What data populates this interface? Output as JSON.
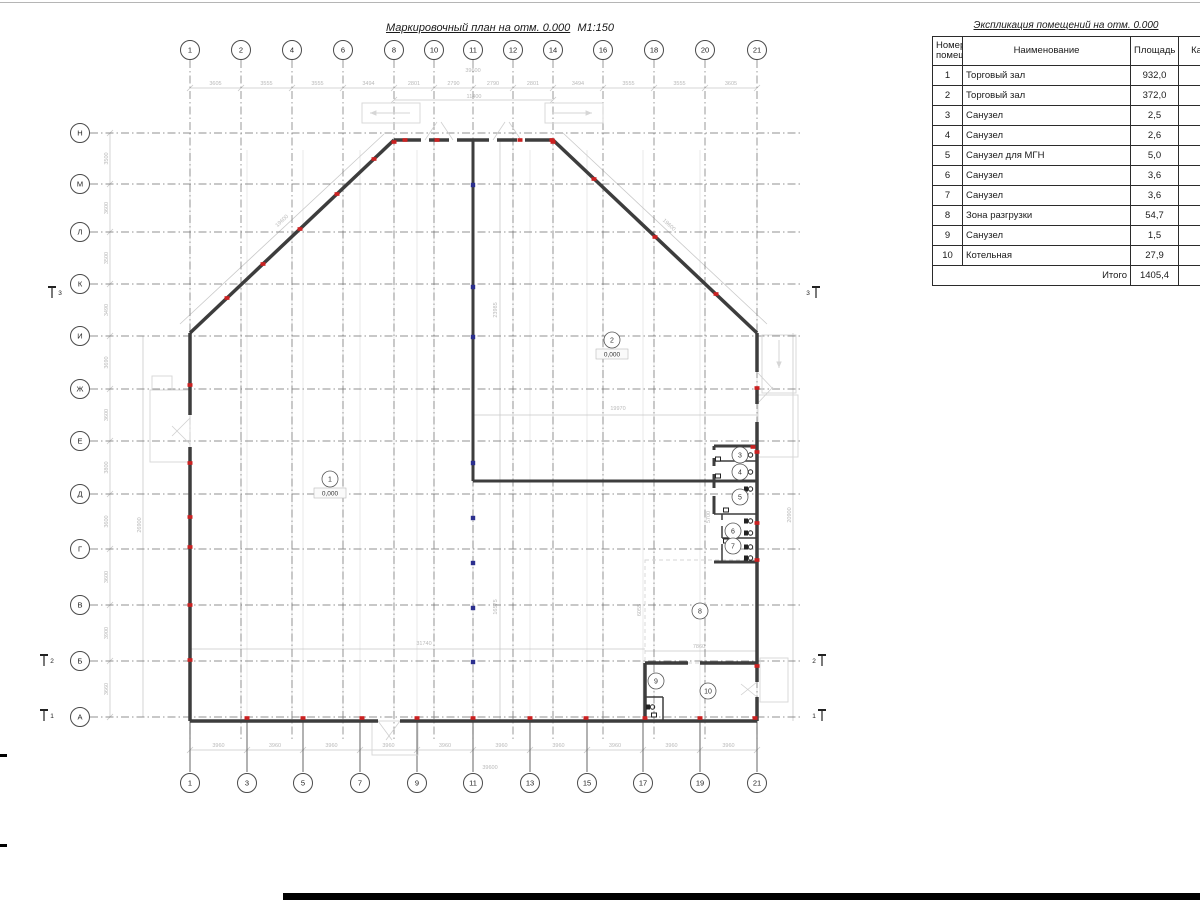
{
  "colors": {
    "wall": "#3d3d3d",
    "grid": "#6f6f6f",
    "grid_faint": "#e3e3e3",
    "dim_line": "#c9c9c9",
    "dim_text": "#b9b9b9",
    "red_marker": "#cc2020",
    "blue_marker": "#2b2f8e",
    "faint_arch": "#d6d6d6"
  },
  "plan": {
    "title": "Маркировочный план на отм. 0.000",
    "scale_note": "М1:150",
    "grid_top": {
      "labels": [
        "1",
        "2",
        "4",
        "6",
        "8",
        "10",
        "11",
        "12",
        "14",
        "16",
        "18",
        "20",
        "21"
      ],
      "x": [
        190,
        241,
        292,
        343,
        394,
        434,
        473,
        513,
        553,
        603,
        654,
        705,
        757
      ],
      "y_bubble": 50
    },
    "grid_bottom": {
      "labels": [
        "1",
        "3",
        "5",
        "7",
        "9",
        "11",
        "13",
        "15",
        "17",
        "19",
        "21"
      ],
      "x": [
        190,
        247,
        303,
        360,
        417,
        473,
        530,
        587,
        643,
        700,
        757
      ],
      "y_bubble": 783
    },
    "grid_rows": {
      "labels": [
        "Н",
        "М",
        "Л",
        "К",
        "И",
        "Ж",
        "Е",
        "Д",
        "Г",
        "В",
        "Б",
        "А"
      ],
      "y": [
        133,
        184,
        232,
        284,
        336,
        389,
        441,
        494,
        549,
        605,
        661,
        717
      ],
      "x_bubble": 80
    },
    "dims": {
      "top_segments": [
        "3605",
        "3555",
        "3555",
        "3494",
        "2801",
        "2790",
        "2790",
        "2801",
        "3494",
        "3555",
        "3555",
        "3605"
      ],
      "top_total": "39600",
      "top_inner": "11400",
      "bottom_segments": [
        "3960",
        "3960",
        "3960",
        "3960",
        "3960",
        "3960",
        "3960",
        "3960",
        "3960",
        "3960"
      ],
      "bottom_total": "39600",
      "left_segments": [
        "3500",
        "3600",
        "3500",
        "3490",
        "3690",
        "3600",
        "3800",
        "3600",
        "3600",
        "3900",
        "3660"
      ],
      "left_inner": "26900",
      "right_side": "20900",
      "misc": [
        {
          "text": "19600",
          "x": 283,
          "y": 222,
          "rot": -43
        },
        {
          "text": "19600",
          "x": 668,
          "y": 226,
          "rot": 43
        },
        {
          "text": "23985",
          "x": 497,
          "y": 310,
          "rot": -90
        },
        {
          "text": "16575",
          "x": 497,
          "y": 607,
          "rot": -90
        },
        {
          "text": "19970",
          "x": 618,
          "y": 410,
          "rot": 0
        },
        {
          "text": "31740",
          "x": 424,
          "y": 645,
          "rot": 0
        },
        {
          "text": "7860",
          "x": 699,
          "y": 648,
          "rot": 0
        },
        {
          "text": "6055",
          "x": 641,
          "y": 610,
          "rot": -90
        },
        {
          "text": "5700",
          "x": 710,
          "y": 517,
          "rot": -90
        }
      ]
    },
    "rooms": [
      {
        "num": "1",
        "x": 330,
        "y": 479,
        "elev": "0,000"
      },
      {
        "num": "2",
        "x": 612,
        "y": 340,
        "elev": "0,000"
      },
      {
        "num": "3",
        "x": 740,
        "y": 455
      },
      {
        "num": "4",
        "x": 740,
        "y": 472
      },
      {
        "num": "5",
        "x": 740,
        "y": 497
      },
      {
        "num": "6",
        "x": 733,
        "y": 531
      },
      {
        "num": "7",
        "x": 733,
        "y": 546
      },
      {
        "num": "8",
        "x": 700,
        "y": 611
      },
      {
        "num": "9",
        "x": 656,
        "y": 681
      },
      {
        "num": "10",
        "x": 708,
        "y": 691
      }
    ],
    "sections": [
      {
        "num": "3",
        "x": 52,
        "y": 293,
        "side": "left"
      },
      {
        "num": "3",
        "x": 816,
        "y": 293,
        "side": "right"
      },
      {
        "num": "2",
        "x": 44,
        "y": 661,
        "side": "left"
      },
      {
        "num": "2",
        "x": 822,
        "y": 661,
        "side": "right"
      },
      {
        "num": "1",
        "x": 44,
        "y": 716,
        "side": "left"
      },
      {
        "num": "1",
        "x": 822,
        "y": 716,
        "side": "right"
      }
    ]
  },
  "table": {
    "title": "Экспликация помещений на отм. 0.000",
    "headers": [
      "Номер помещ.",
      "Наименование",
      "Площадь",
      "Кат. пом."
    ],
    "rows": [
      [
        "1",
        "Торговый зал",
        "932,0"
      ],
      [
        "2",
        "Торговый зал",
        "372,0"
      ],
      [
        "3",
        "Санузел",
        "2,5"
      ],
      [
        "4",
        "Санузел",
        "2,6"
      ],
      [
        "5",
        "Санузел для МГН",
        "5,0"
      ],
      [
        "6",
        "Санузел",
        "3,6"
      ],
      [
        "7",
        "Санузел",
        "3,6"
      ],
      [
        "8",
        "Зона разгрузки",
        "54,7"
      ],
      [
        "9",
        "Санузел",
        "1,5"
      ],
      [
        "10",
        "Котельная",
        "27,9"
      ]
    ],
    "total_label": "Итого",
    "total_value": "1405,4"
  }
}
